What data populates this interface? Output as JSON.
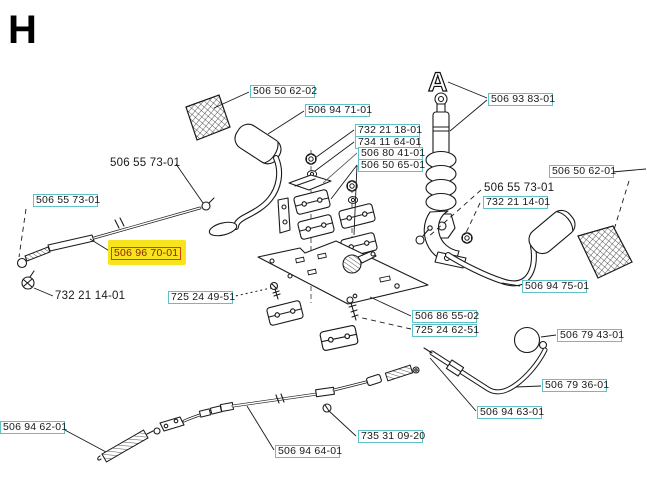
{
  "page_title": "H",
  "drawing": {
    "shock_marker": "A"
  },
  "colors": {
    "label_border": "#5fc2c8",
    "label_text": "#1a1a1a",
    "highlight_bg": "#f7e41c",
    "highlight_border": "#d93a0f",
    "highlight_text": "#8a2400",
    "line": "#1a1a1a",
    "background": "#ffffff"
  },
  "labels": [
    {
      "text": "506 50 62-02",
      "style": "boxed"
    },
    {
      "text": "506 94 71-01",
      "style": "boxed"
    },
    {
      "text": "732 21 18-01",
      "style": "boxed"
    },
    {
      "text": "734 11 64-01",
      "style": "boxed"
    },
    {
      "text": "506 80 41-01",
      "style": "boxed"
    },
    {
      "text": "506 50 65-01",
      "style": "boxed"
    },
    {
      "text": "506 93 83-01",
      "style": "boxed"
    },
    {
      "text": "506 55 73-01",
      "style": "plain"
    },
    {
      "text": "506 55 73-01",
      "style": "boxed"
    },
    {
      "text": "506 96 70-01",
      "style": "highlight"
    },
    {
      "text": "732 21 14-01",
      "style": "plain"
    },
    {
      "text": "725 24 49-51",
      "style": "boxed"
    },
    {
      "text": "506 55 73-01",
      "style": "plain"
    },
    {
      "text": "732 21 14-01",
      "style": "boxed"
    },
    {
      "text": "506 50 62-01",
      "style": "boxed"
    },
    {
      "text": "506 94 75-01",
      "style": "boxed"
    },
    {
      "text": "506 86 55-02",
      "style": "boxed"
    },
    {
      "text": "725 24 62-51",
      "style": "boxed"
    },
    {
      "text": "506 79 43-01",
      "style": "boxed"
    },
    {
      "text": "506 79 36-01",
      "style": "boxed"
    },
    {
      "text": "506 94 63-01",
      "style": "boxed"
    },
    {
      "text": "506 94 62-01",
      "style": "boxed"
    },
    {
      "text": "506 94 64-01",
      "style": "boxed"
    },
    {
      "text": "735 31 09-20",
      "style": "boxed"
    }
  ]
}
